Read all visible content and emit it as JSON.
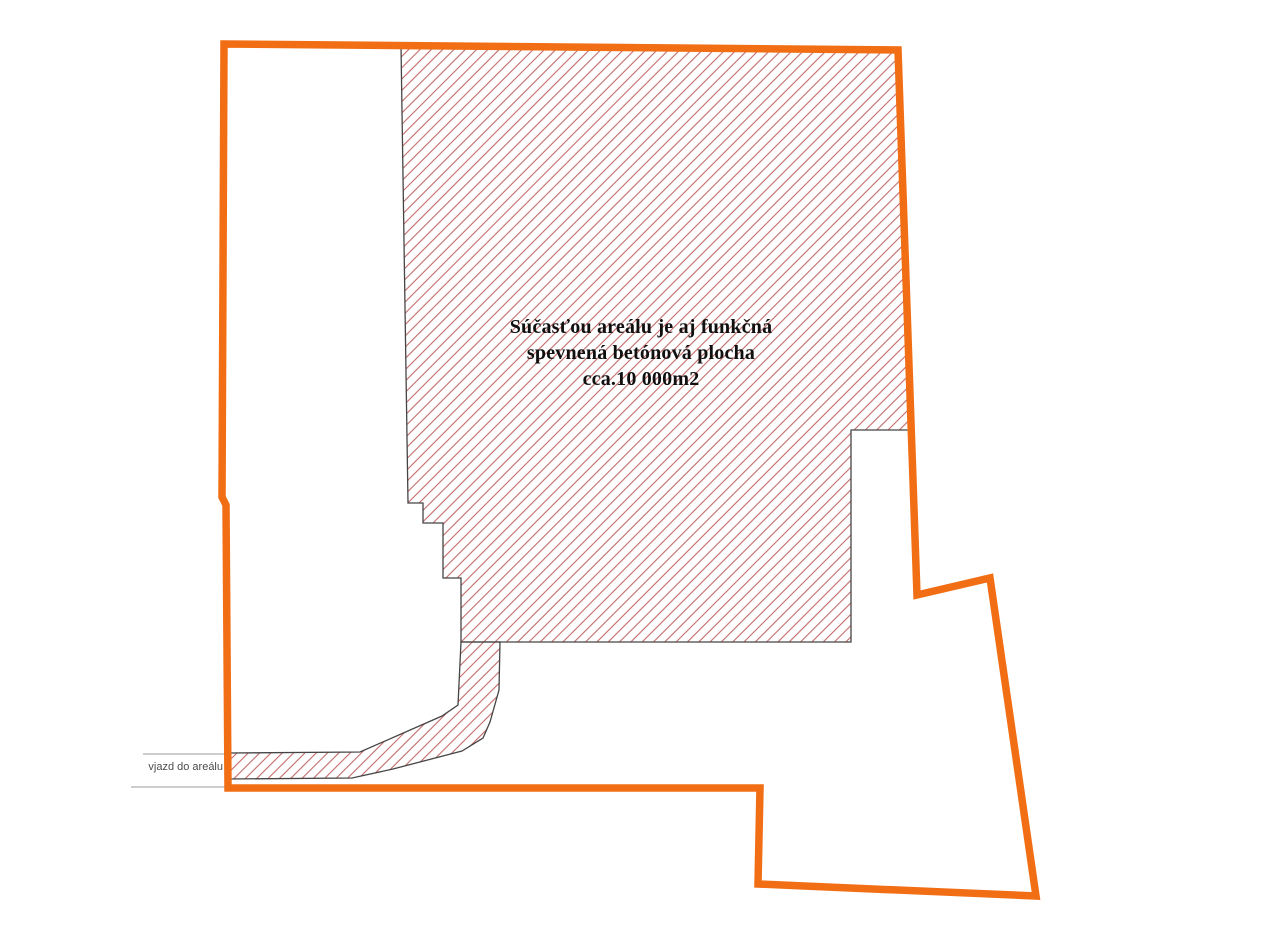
{
  "annotation": {
    "line1": "Súčasťou areálu je aj funkčná",
    "line2": "spevnená betónová plocha",
    "line3": "cca.10 000m2"
  },
  "entrance": {
    "label": "vjazd do areálu"
  },
  "colors": {
    "boundary_orange": "#f26e15",
    "hatch_line_red": "#c26a6a",
    "hatch_outline_gray": "#454545",
    "callout_line_gray": "#9b9b9b",
    "entrance_label_gray": "#4d4d4d",
    "annotation_text": "#101010",
    "background": "#ffffff"
  }
}
